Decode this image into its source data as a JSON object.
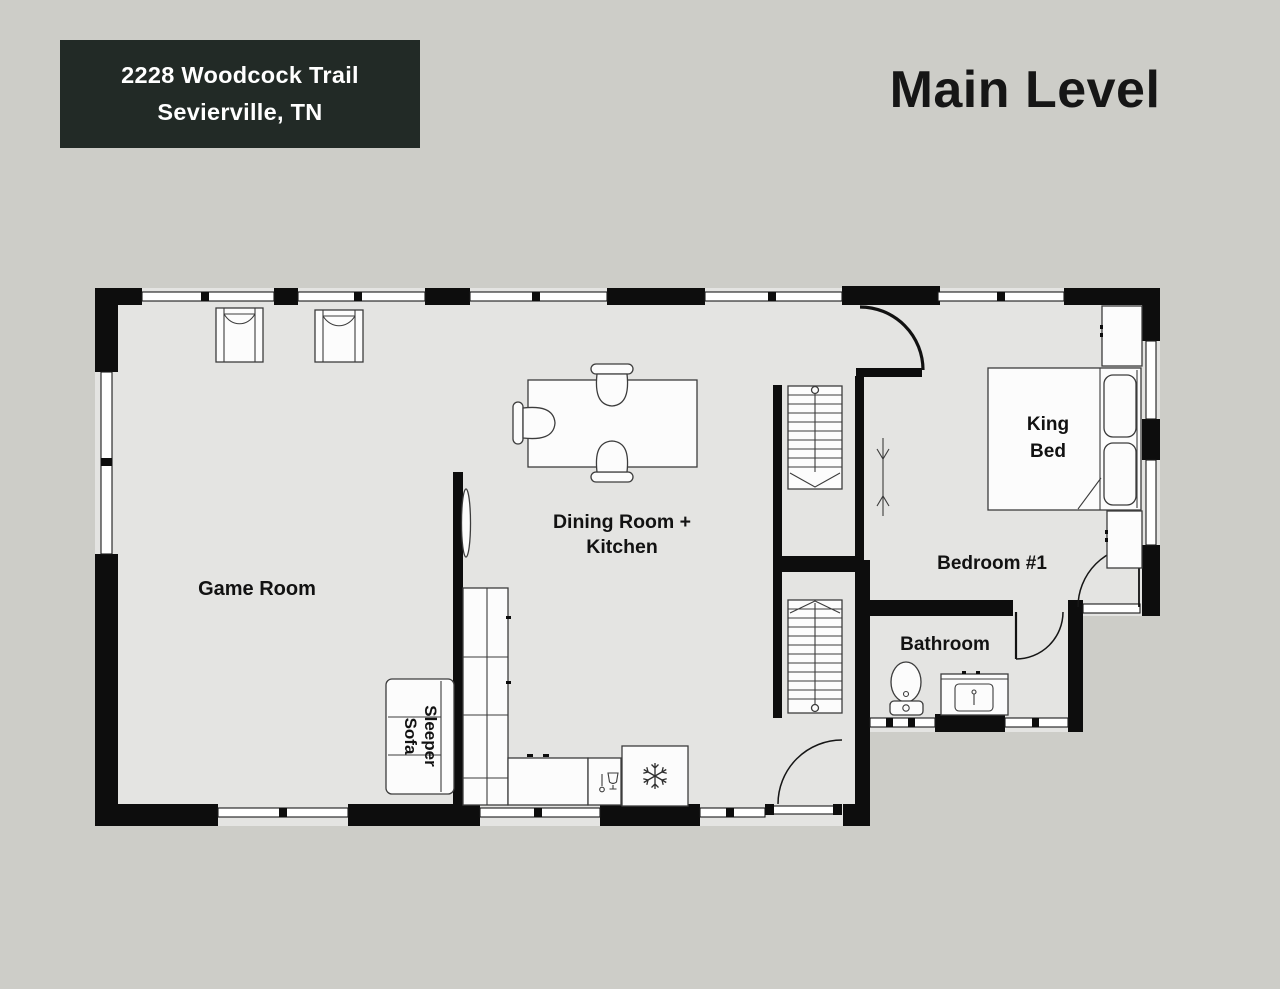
{
  "colors": {
    "background": "#cdcdc8",
    "floor": "#e4e4e2",
    "wall": "#0d0d0d",
    "address_box": "#222a26",
    "label_text": "#121212",
    "furniture_stroke": "#3c3c3c"
  },
  "header": {
    "address_line1": "2228 Woodcock Trail",
    "address_line2": "Sevierville, TN",
    "title": "Main Level"
  },
  "rooms": {
    "game_room": "Game Room",
    "dining_line1": "Dining Room +",
    "dining_line2": "Kitchen",
    "bedroom": "Bedroom #1",
    "bathroom": "Bathroom"
  },
  "furniture": {
    "king_bed_line1": "King",
    "king_bed_line2": "Bed",
    "sleeper_sofa_line1": "Sleeper",
    "sleeper_sofa_line2": "Sofa"
  },
  "icons": {
    "fridge": "snowflake-icon",
    "stove": "stove-icon",
    "stairs_down": "stair-down-arrow",
    "stairs_up": "stair-up-arrow"
  }
}
